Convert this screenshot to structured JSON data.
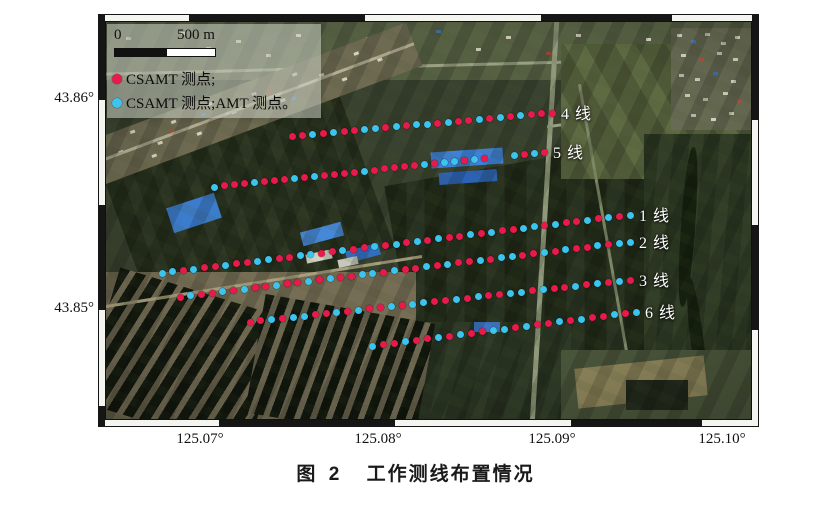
{
  "figure": {
    "caption_prefix": "图 2",
    "caption": "工作测线布置情况"
  },
  "map": {
    "legend": {
      "scale_zero": "0",
      "scale_label": "500 m",
      "items": [
        {
          "type": "csamt",
          "color": "#e8194b",
          "label": "CSAMT 测点;"
        },
        {
          "type": "csamt_amt",
          "color": "#3cc3ee",
          "label": "CSAMT 测点;AMT 测点。"
        }
      ]
    },
    "axes": {
      "lat_ticks": [
        {
          "label": "43.86°",
          "y": 100
        },
        {
          "label": "43.85°",
          "y": 310
        }
      ],
      "lon_ticks": [
        {
          "label": "125.07°",
          "x": 200
        },
        {
          "label": "125.08°",
          "x": 378
        },
        {
          "label": "125.09°",
          "x": 552
        },
        {
          "label": "125.10°",
          "x": 722
        }
      ]
    },
    "point_colors": {
      "r": "#e8194b",
      "c": "#3cc3ee"
    },
    "point_legend": {
      "r": "CSAMT 测点",
      "c": "CSAMT 测点;AMT 测点"
    },
    "survey_lines": [
      {
        "label": "4 线",
        "x1": 186,
        "y1": 114,
        "x2": 446,
        "y2": 91,
        "pattern": "rrcrcrrccrcrccrcrrcrcrcrrr"
      },
      {
        "label": "5 线",
        "x1": 108,
        "y1": 165,
        "x2": 438,
        "y2": 130,
        "pattern": "crrrcrrrcrcrrrrcrrrrrcrccrcr__crcr"
      },
      {
        "label": "1 线",
        "x1": 56,
        "y1": 251,
        "x2": 524,
        "y2": 193,
        "pattern": "ccrcrrcrrccrrccrrcrrcrcrcrcrrcrcrrccrcrrcrcrc"
      },
      {
        "label": "2 线",
        "x1": 74,
        "y1": 275,
        "x2": 524,
        "y2": 220,
        "pattern": "rcrrcrcrrcrrcrcrrccrcrrcrcrrcrccrrcrcrrcrcc"
      },
      {
        "label": "3 线",
        "x1": 144,
        "y1": 300,
        "x2": 524,
        "y2": 258,
        "pattern": "rrcrccrrcrcrrcrccrrcrcrrccrcrrcrcrcr"
      },
      {
        "label": "6 线",
        "x1": 266,
        "y1": 324,
        "x2": 530,
        "y2": 290,
        "pattern": "crrcrrcrcrrccrcrrcrcrrcrc"
      }
    ]
  }
}
